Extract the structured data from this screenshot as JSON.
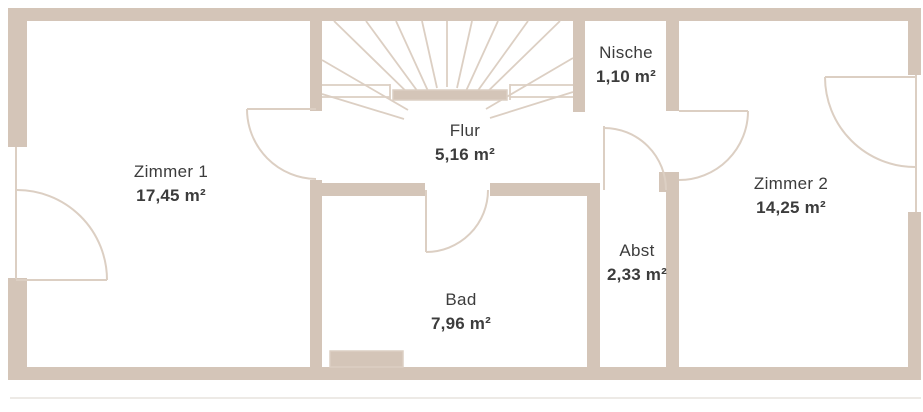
{
  "plan_title": "Floor plan",
  "rooms": [
    {
      "id": "zimmer1",
      "name": "Zimmer 1",
      "area": "17,45 m²"
    },
    {
      "id": "flur",
      "name": "Flur",
      "area": "5,16 m²"
    },
    {
      "id": "nische",
      "name": "Nische",
      "area": "1,10 m²"
    },
    {
      "id": "zimmer2",
      "name": "Zimmer 2",
      "area": "14,25 m²"
    },
    {
      "id": "abst",
      "name": "Abst",
      "area": "2,33 m²"
    },
    {
      "id": "bad",
      "name": "Bad",
      "area": "7,96 m²"
    }
  ],
  "colors": {
    "wall": "#d4c5b8",
    "line": "#dccfc3",
    "text": "#3c3c3c",
    "background": "#ffffff"
  }
}
